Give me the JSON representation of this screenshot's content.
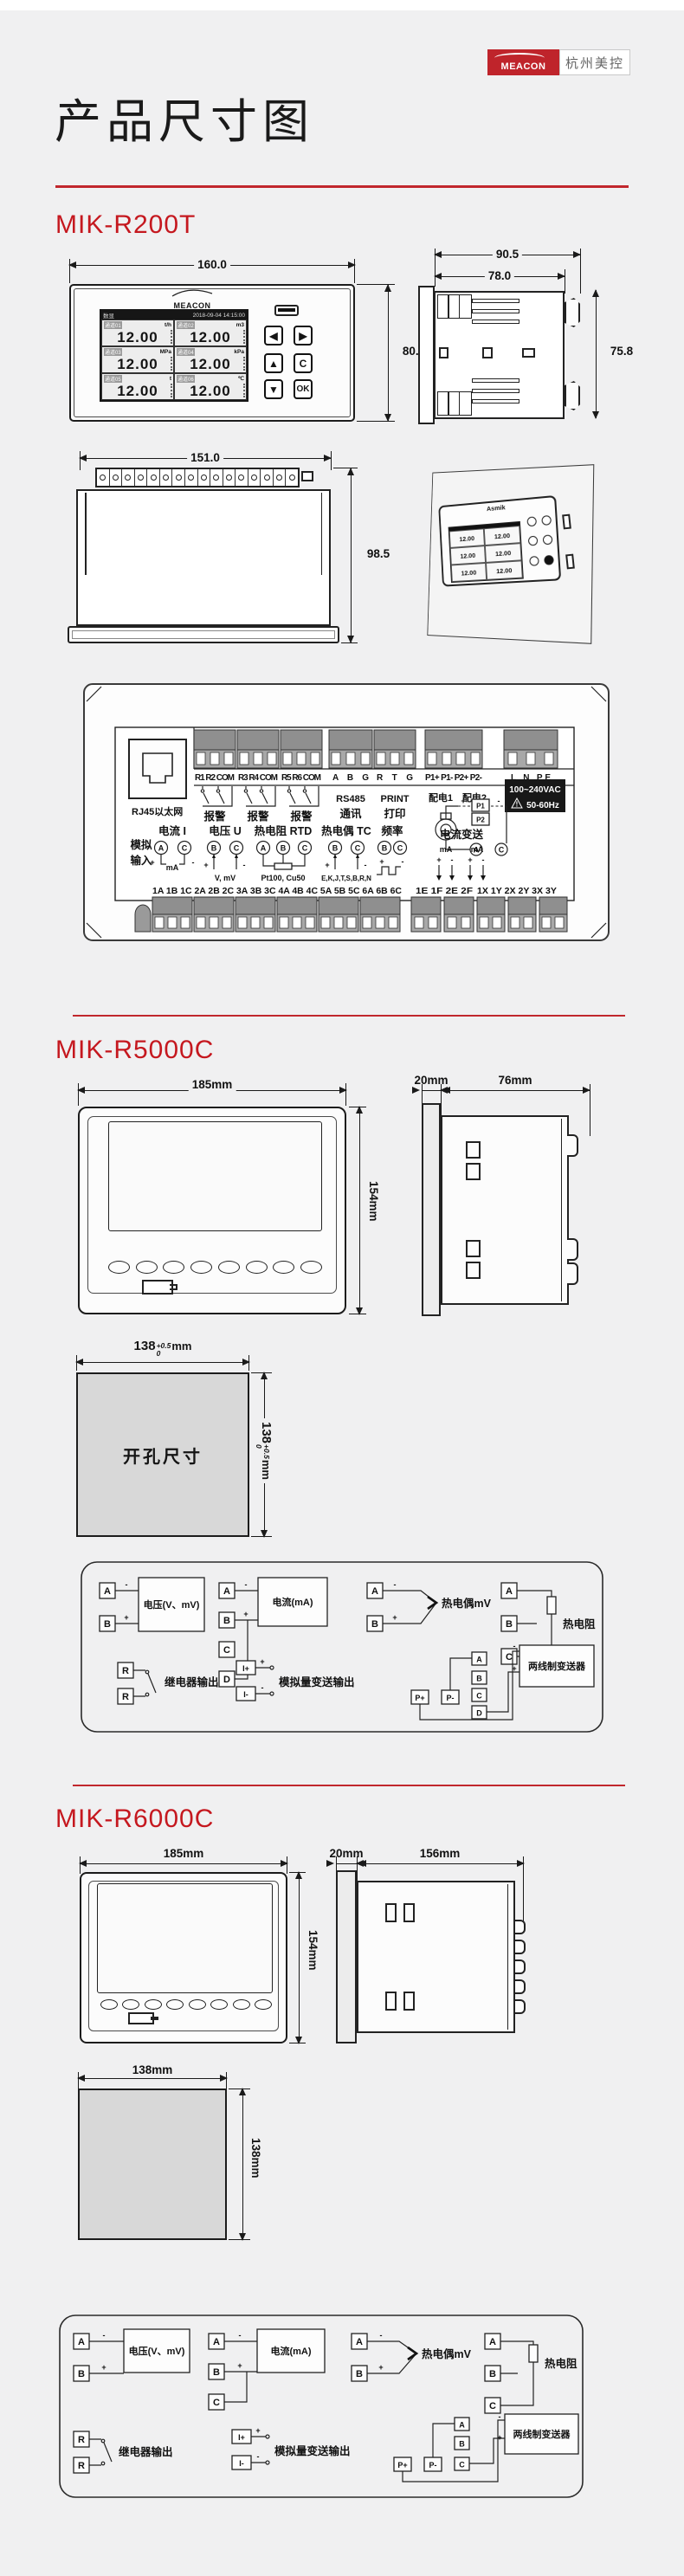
{
  "header": {
    "brand": "MEACON",
    "company": "杭州美控"
  },
  "title": "产品尺寸图",
  "sym": {
    "plus": "+",
    "minus": "-"
  },
  "r200t": {
    "heading": "MIK-R200T",
    "front": {
      "dim_w": "160.0",
      "dim_h": "80.0",
      "brand": "MEACON",
      "screen_mode": "数显",
      "screen_time": "2018-09-04 14:15:00",
      "channels": [
        {
          "name": "通道01",
          "unit": "t/h",
          "value": "12.00"
        },
        {
          "name": "通道02",
          "unit": "m3",
          "value": "12.00"
        },
        {
          "name": "通道03",
          "unit": "MPa",
          "value": "12.00"
        },
        {
          "name": "通道04",
          "unit": "kPa",
          "value": "12.00"
        },
        {
          "name": "通道05",
          "unit": "t",
          "value": "12.00"
        },
        {
          "name": "通道06",
          "unit": "℃",
          "value": "12.00"
        }
      ],
      "keys": [
        "◀",
        "▶",
        "▲",
        "C",
        "▼",
        "OK"
      ]
    },
    "side": {
      "dim_total": "90.5",
      "dim_depth": "78.0",
      "dim_h": "75.8"
    },
    "top": {
      "dim_w": "151.0",
      "dim_h": "98.5"
    },
    "persp": {
      "brand": "Asmik"
    },
    "rear": {
      "eth": "RJ45以太网",
      "groups": [
        "R1 R2 COM",
        "R3 R4 COM",
        "R5 R6 COM",
        "A B G",
        "R T G",
        "P1+ P1- P2+ P2-",
        "L N PE"
      ],
      "alarm": "报警",
      "rs485_1": "RS485",
      "rs485_2": "通讯",
      "print_1": "PRINT",
      "print_2": "打印",
      "pd1": "配电1",
      "pd2": "配电2",
      "p1": "P1",
      "p2": "P2",
      "power_1": "100~240VAC",
      "power_2": "50-60Hz",
      "warn": "!",
      "ai_label_1": "模拟",
      "ai_label_2": "输入",
      "cur_t": "电流 I",
      "cur_a": "A",
      "cur_c": "C",
      "cur_ma": "mA",
      "volt_t": "电压 U",
      "volt_b": "B",
      "volt_c": "C",
      "volt_note": "V, mV",
      "rtd_t": "热电阻 RTD",
      "rtd_a": "A",
      "rtd_b": "B",
      "rtd_c": "C",
      "rtd_note": "Pt100, Cu50",
      "tc_t": "热电偶 TC",
      "tc_b": "B",
      "tc_c": "C",
      "tc_note": "E,K,J,T,S,B,R,N",
      "freq_t": "频率",
      "freq_b": "B",
      "freq_c": "C",
      "ret_t": "电流变送",
      "ret_ma1": "mA",
      "ret_ma2": "mA",
      "pda": "A",
      "pdc": "C",
      "nums1": "1A 1B 1C 2A 2B 2C 3A 3B 3C 4A 4B 4C 5A 5B 5C 6A 6B 6C",
      "nums2": "1E 1F 2E 2F",
      "nums3": "1X 1Y 2X 2Y 3X 3Y"
    }
  },
  "r5000c": {
    "heading": "MIK-R5000C",
    "front": {
      "dim_w": "185mm",
      "dim_h": "154mm"
    },
    "side": {
      "dim_bezel": "20mm",
      "dim_depth": "76mm"
    },
    "cutout": {
      "label": "开孔尺寸",
      "dim": "138",
      "tol_up": "+0.5",
      "tol_dn": "0",
      "unit": "mm"
    },
    "wiring": {
      "volt_label": "电压(V、mV)",
      "cur_label": "电流(mA)",
      "tc_label": "热电偶mV",
      "rtd_label": "热电阻",
      "relay_label": "继电器输出",
      "aout_label": "模拟量变送输出",
      "trans_label": "两线制变送器",
      "a": "A",
      "b": "B",
      "c": "C",
      "d": "D",
      "r": "R",
      "ip": "I+",
      "im": "I-",
      "pp": "P+",
      "pm": "P-"
    }
  },
  "r6000c": {
    "heading": "MIK-R6000C",
    "front": {
      "dim_w": "185mm",
      "dim_h": "154mm"
    },
    "side": {
      "dim_bezel": "20mm",
      "dim_depth": "156mm"
    },
    "cutout": {
      "dim_w": "138mm",
      "dim_h": "138mm"
    },
    "wiring": {
      "volt_label": "电压(V、mV)",
      "cur_label": "电流(mA)",
      "tc_label": "热电偶mV",
      "rtd_label": "热电阻",
      "relay_label": "继电器输出",
      "aout_label": "模拟量变送输出",
      "trans_label": "两线制变送器",
      "a": "A",
      "b": "B",
      "c": "C",
      "r": "R",
      "ip": "I+",
      "im": "I-",
      "pp": "P+",
      "pm": "P-"
    }
  }
}
